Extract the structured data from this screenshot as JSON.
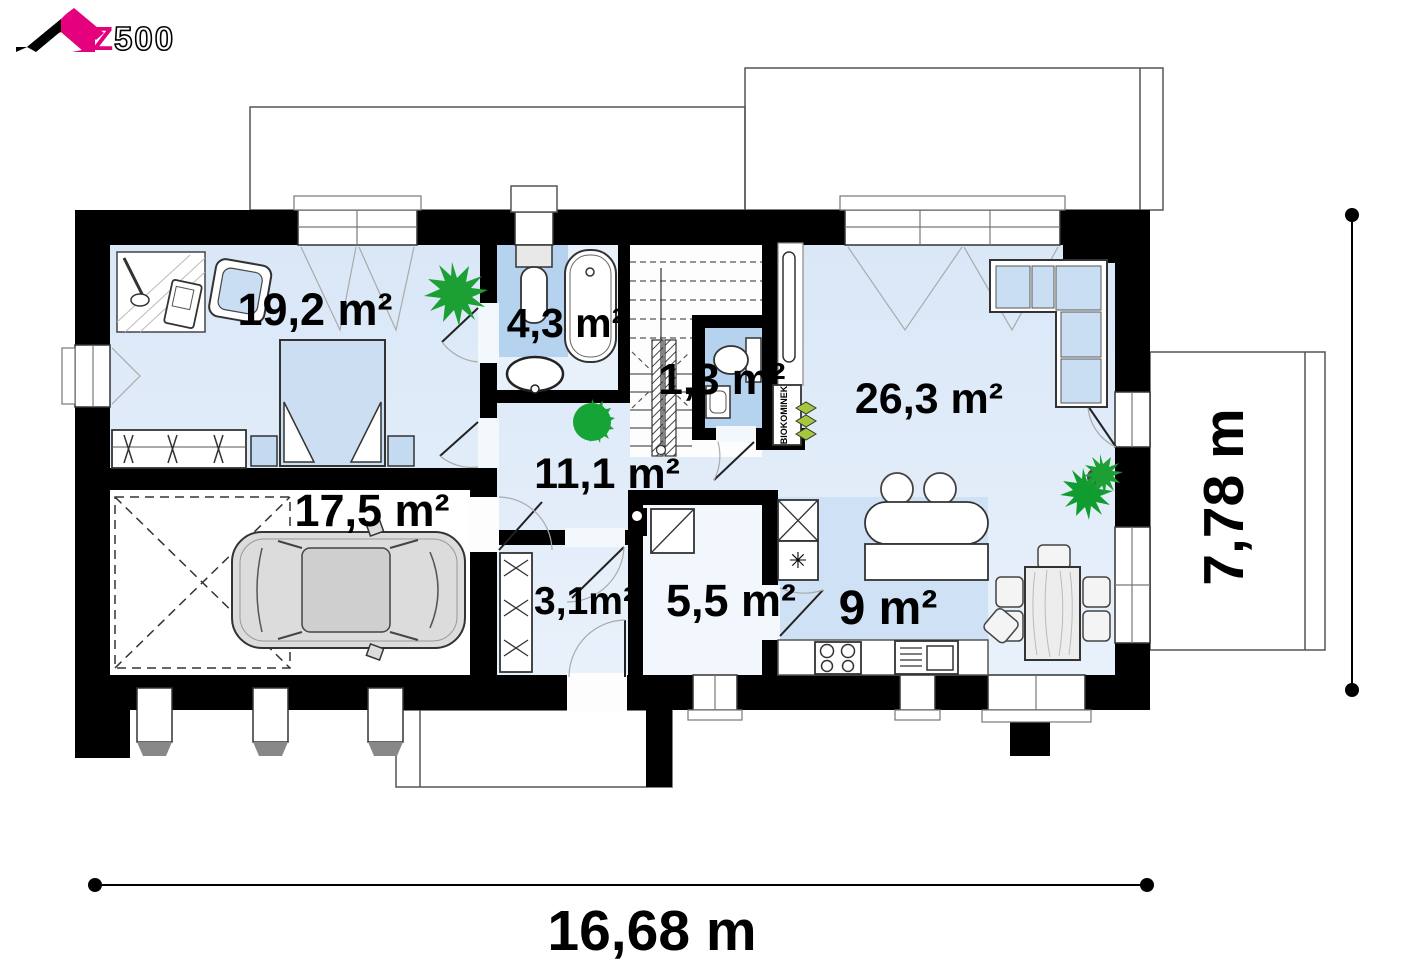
{
  "logo": {
    "brand_z": "Z",
    "brand_digits": "500"
  },
  "rooms": [
    {
      "id": "bedroom",
      "label": "19,2 m²"
    },
    {
      "id": "bathroom",
      "label": "4,3 m²"
    },
    {
      "id": "wc",
      "label": "1,3 m²"
    },
    {
      "id": "living_room",
      "label": "26,3 m²"
    },
    {
      "id": "hall",
      "label": "11,1 m²"
    },
    {
      "id": "garage",
      "label": "17,5 m²"
    },
    {
      "id": "vestibule",
      "label": "3,1m²"
    },
    {
      "id": "utility",
      "label": "5,5 m²"
    },
    {
      "id": "kitchen",
      "label": "9 m²"
    }
  ],
  "dimensions": {
    "total_width": "16,68 m",
    "total_depth": "7,78 m"
  },
  "annotations": {
    "fireplace": "BIOKOMINEK"
  },
  "colors": {
    "accent_pink": "#e5007d",
    "floor_light": "#dfeafa",
    "floor_medium": "#b5d3ef",
    "kitchen_floor": "#cfe1f4",
    "plant_green": "#1ca033",
    "chevron_green": "#a3c83c"
  }
}
